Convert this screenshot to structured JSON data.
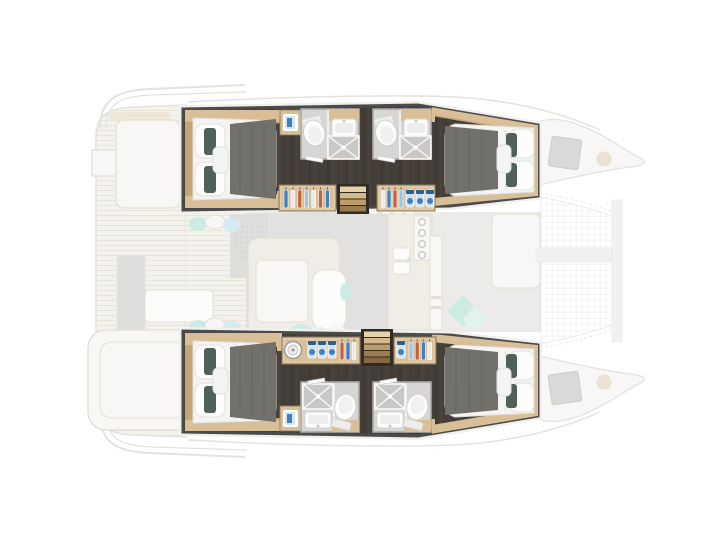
{
  "meta": {
    "description": "Catamaran yacht floor plan, top-down view: two highlighted hulls with four double cabins, four bathrooms, wardrobes and companionway stairs; faded main-deck saloon, galley, cockpit and bow trampoline in background",
    "cabin_count": 4,
    "bathroom_count": 4
  },
  "colors": {
    "canvas": "#ffffff",
    "hullBorder": "#4b4b4b",
    "borderHalo": "#f1f0ee",
    "hullFloor": "#453f39",
    "floorStreakDark": "#39342e",
    "floorStreakLight": "#584f44",
    "wood": "#d8bf97",
    "woodDark": "#c3a577",
    "woodEdge": "#8a795a",
    "bedWhite": "#f4f4f2",
    "bedShadow": "#dfdfdd",
    "fixtureWhite": "#fcfcfb",
    "runner": "#72706b",
    "runnerStreak": "#615f5a",
    "pillowTeal": "#4f6158",
    "bathFloor": "#d7d6d4",
    "bathWall": "#a9a9a7",
    "showerFloor": "#c9c8c6",
    "seatBlue": "#cfe8f3",
    "itemBlue": "#4080c0",
    "itemBlueDark": "#2d5e92",
    "jarBlue": "#cfe2f3",
    "hangerOrange": "#c2633b",
    "hangerLightBlue": "#9dc5e5",
    "hangerWhite": "#eaeae8",
    "stair1": "#e7d1a9",
    "stair2": "#d4ba8a",
    "stair3": "#bc9d6a",
    "stair4": "#9b7d4f",
    "stair5": "#85693f",
    "stairWell": "#2f2b26",
    "teak": "#f4f2ed",
    "teakLine": "#e8e4da",
    "fadedLine": "#e4e2de",
    "fadedFill": "#f8f7f5",
    "fadedFurniture": "#f0ede7",
    "furnitureLine": "#e4dfd4",
    "grayPanel": "#dededc",
    "salonFloorL": "#e2e1df",
    "salonFloorR": "#ecebe9",
    "windowLine": "#e5e3e0",
    "hatchGray": "#d9d9d7",
    "meshLine": "#eaedef",
    "beamGray": "#eff1f2",
    "fadedTealA": "#cdebe5",
    "fadedTealB": "#e1f3ef",
    "fadedBlue": "#d6eaf3",
    "fadedTan": "#ece3d2",
    "dotGray": "#cccac7"
  },
  "wardrobes": {
    "port_aft": [
      "blue",
      "white",
      "orange",
      "lightblue",
      "white",
      "orange",
      "blue"
    ],
    "port_fwd": [
      "white",
      "blue",
      "orange",
      "lightblue"
    ],
    "stbd_aft": [
      "orange",
      "blue",
      "white"
    ],
    "stbd_fwd": [
      "lightblue",
      "orange",
      "blue",
      "white"
    ]
  }
}
